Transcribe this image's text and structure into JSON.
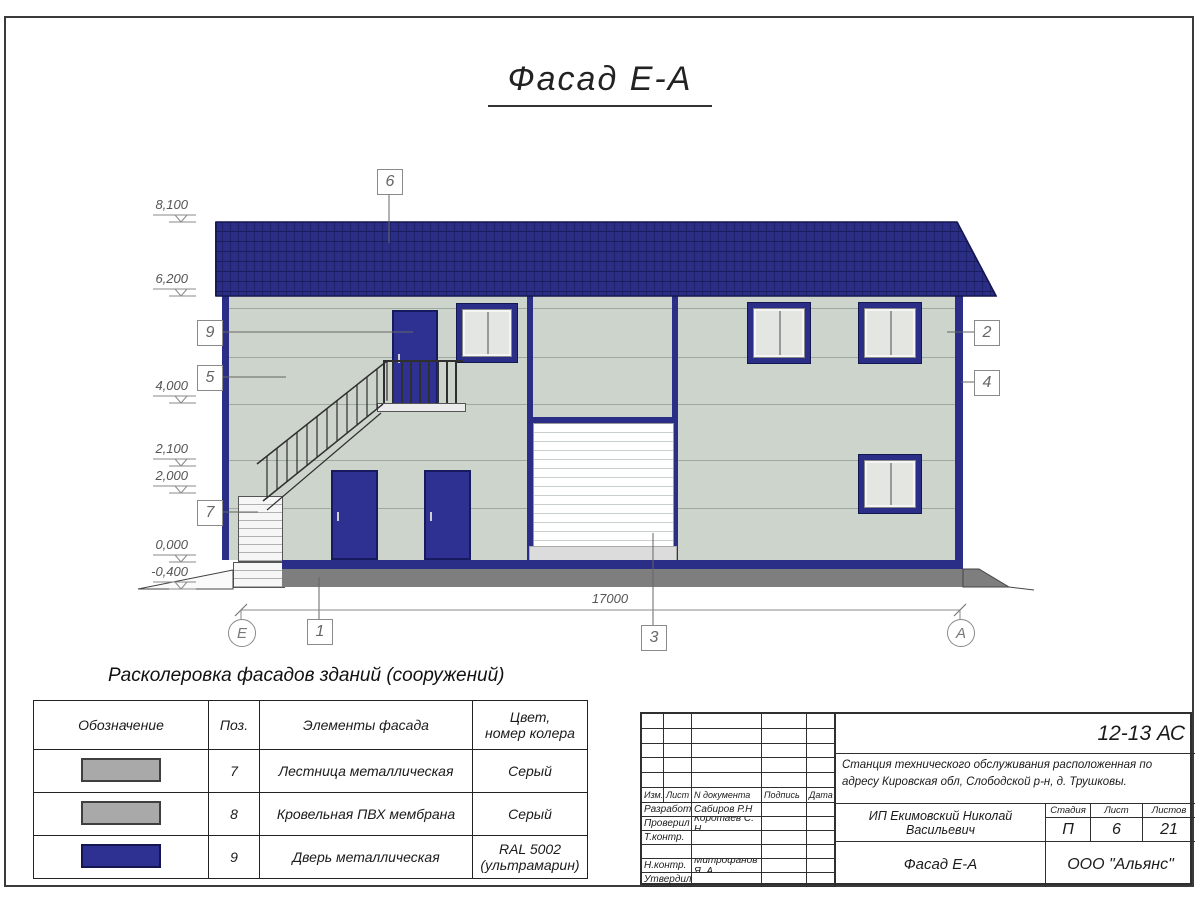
{
  "sheet": {
    "title": "Фасад Е-А"
  },
  "elevation_marks": [
    "8,100",
    "6,200",
    "4,000",
    "2,100",
    "2,000",
    "0,000",
    "-0,400"
  ],
  "callouts": [
    "6",
    "9",
    "5",
    "7",
    "2",
    "4",
    "1",
    "3"
  ],
  "axes": {
    "left": "Е",
    "right": "А",
    "dimension": "17000"
  },
  "legend": {
    "heading": "Расколеровка фасадов зданий (сооружений)",
    "headers": [
      "Обозначение",
      "Поз.",
      "Элементы фасада",
      "Цвет,\nномер колера"
    ],
    "rows": [
      {
        "pos": "7",
        "element": "Лестница металлическая",
        "color": "Серый",
        "swatch": "#a9a9a9",
        "swatch_border": "#3f3f3f"
      },
      {
        "pos": "8",
        "element": "Кровельная ПВХ мембрана",
        "color": "Серый",
        "swatch": "#a9a9a9",
        "swatch_border": "#3f3f3f"
      },
      {
        "pos": "9",
        "element": "Дверь металлическая",
        "color": "RAL 5002\n(ультрамарин)",
        "swatch": "#2e3192",
        "swatch_border": "#14164f"
      }
    ]
  },
  "titleblock": {
    "code": "12-13 АС",
    "project": "Станция технического обслуживания расположенная по адресу Кировская обл, Слободской р-н, д. Трушковы.",
    "client": "ИП Екимовский Николай Васильевич",
    "sheet_name": "Фасад Е-А",
    "company": "ООО \"Альянс\"",
    "rev_headers": [
      "Изм.",
      "Лист",
      "N документа",
      "Подпись",
      "Дата"
    ],
    "staff": [
      {
        "role": "Разработал",
        "name": "Сабиров Р.Н"
      },
      {
        "role": "Проверил",
        "name": "Коротаев С. Н."
      },
      {
        "role": "Т.контр.",
        "name": ""
      },
      {
        "role": "",
        "name": ""
      },
      {
        "role": "Н.контр.",
        "name": "Митрофанов Я. А."
      },
      {
        "role": "Утвердил",
        "name": ""
      }
    ],
    "stage_label": "Стадия",
    "sheet_label": "Лист",
    "sheets_label": "Листов",
    "stage": "П",
    "sheet_num": "6",
    "sheets_total": "21"
  },
  "colors": {
    "roof_blue": "#2b2e86",
    "door_blue": "#2e3192",
    "wall": "#ccd4cb",
    "plinth_gray": "#7e7e7e",
    "step_gray": "#a9a9a9"
  }
}
